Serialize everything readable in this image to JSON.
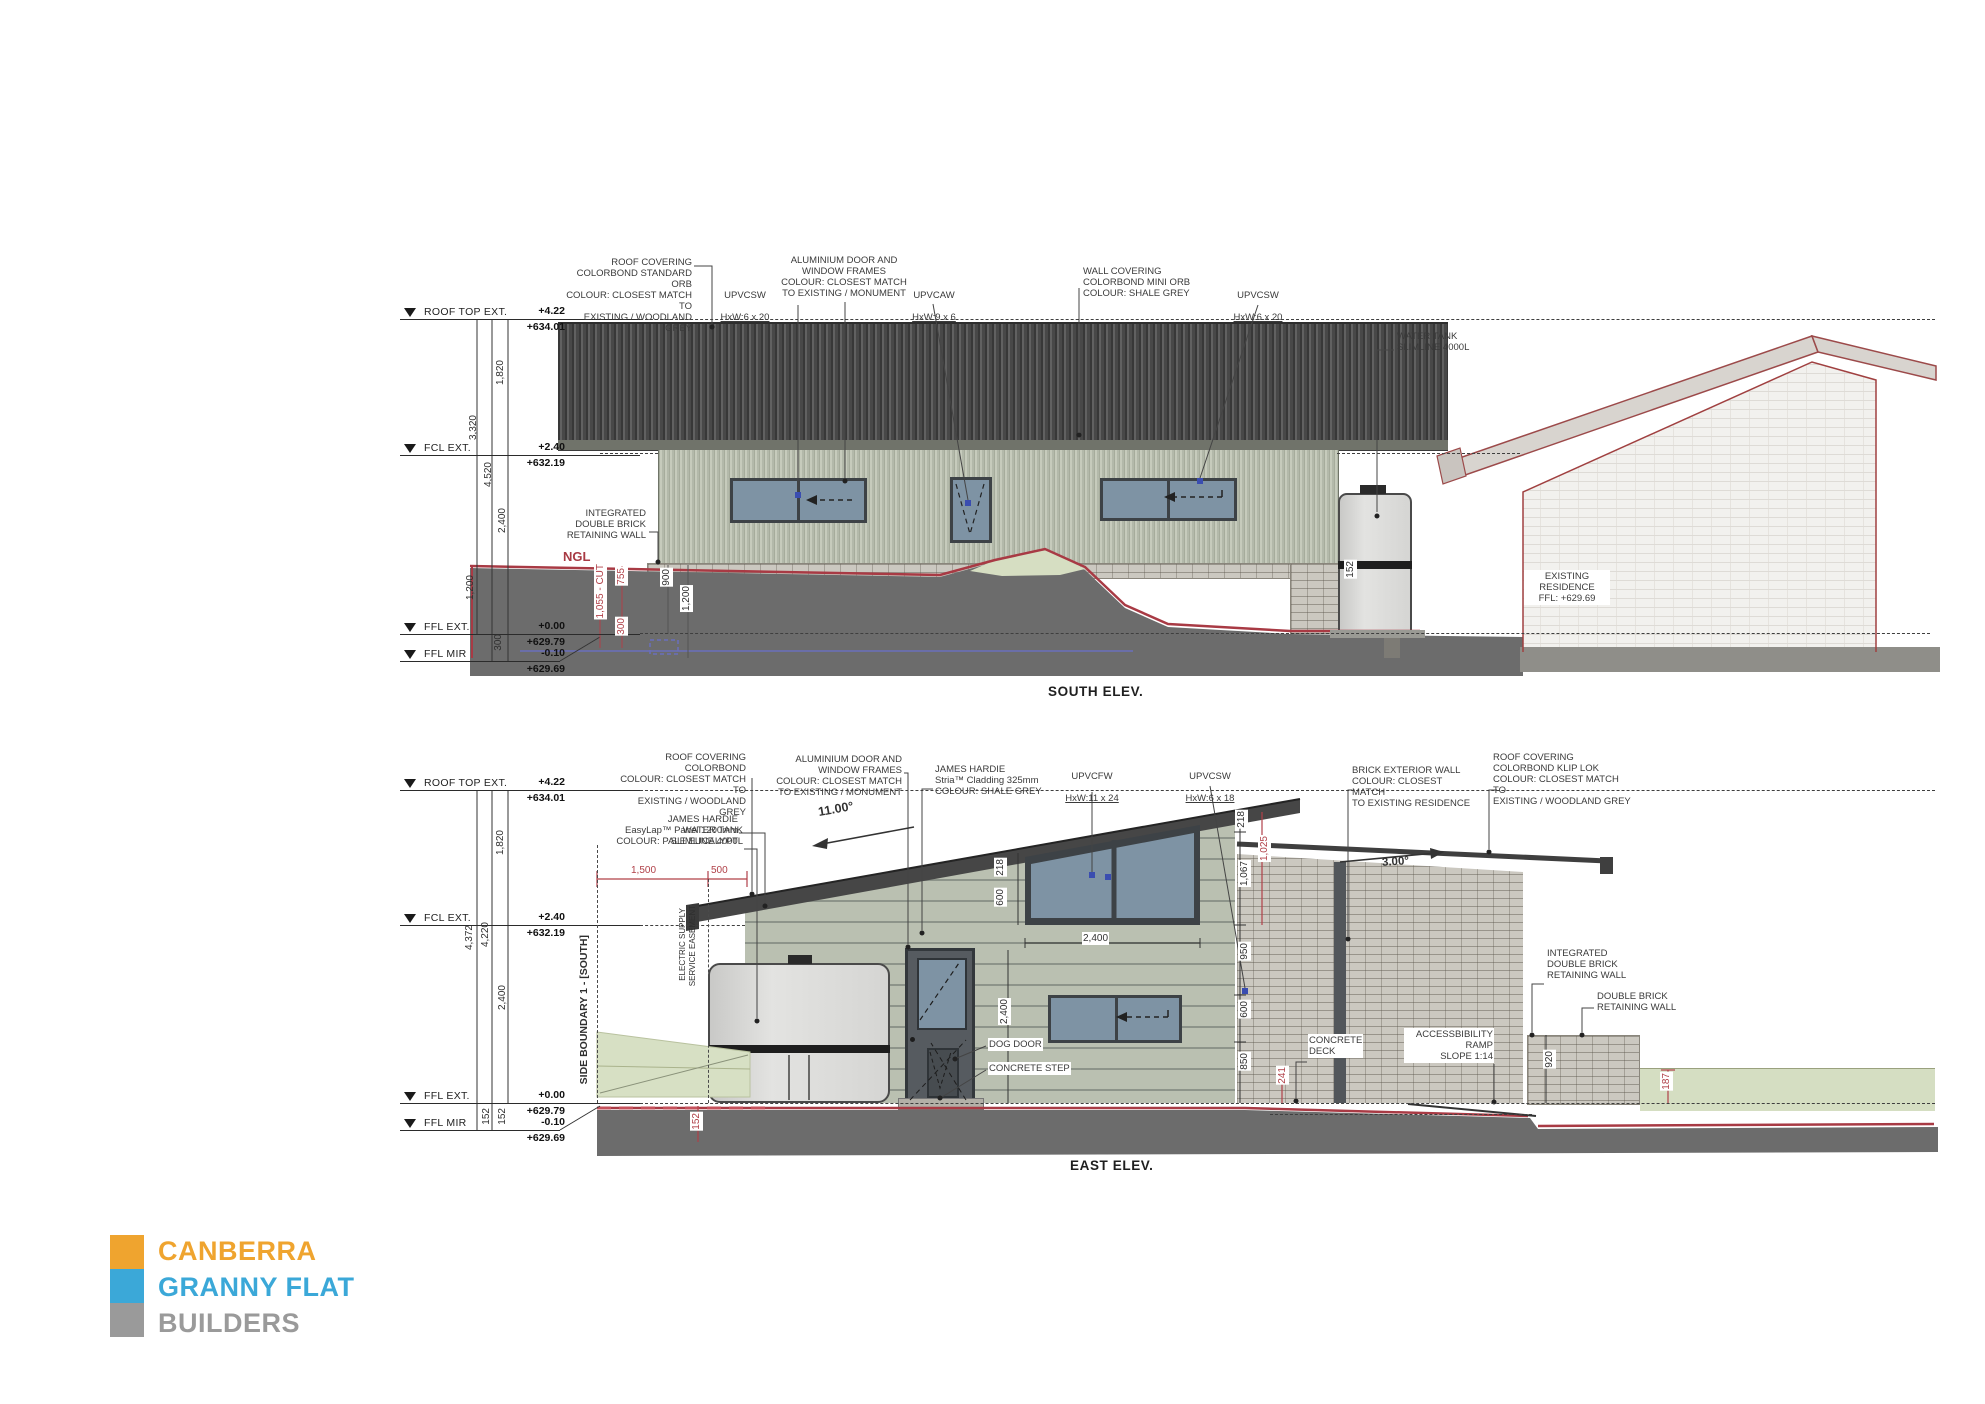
{
  "south": {
    "title": "SOUTH ELEV.",
    "datums": [
      {
        "label": "ROOF TOP EXT.",
        "rel": "+4.22",
        "abs": "+634.01"
      },
      {
        "label": "FCL EXT.",
        "rel": "+2.40",
        "abs": "+632.19"
      },
      {
        "label": "FFL EXT.",
        "rel": "+0.00",
        "abs": "+629.79"
      },
      {
        "label": "FFL MIR",
        "rel": "-0.10",
        "abs": "+629.69"
      }
    ],
    "ann": {
      "roof": "ROOF COVERING\nCOLORBOND STANDARD ORB\nCOLOUR: CLOSEST MATCH TO\nEXISTING / WOODLAND GREY",
      "upvc1_name": "UPVCSW",
      "upvc1_size": "HxW:6 x 20",
      "alu": "ALUMINIUM DOOR AND\nWINDOW FRAMES\nCOLOUR: CLOSEST MATCH\nTO EXISTING / MONUMENT",
      "upvc2_name": "UPVCAW",
      "upvc2_size": "HxW:9 x 6",
      "wall": "WALL COVERING\nCOLORBOND MINI ORB\nCOLOUR: SHALE GREY",
      "upvc3_name": "UPVCSW",
      "upvc3_size": "HxW:6 x 20",
      "retaining": "INTEGRATED\nDOUBLE BRICK\nRETAINING WALL",
      "ngl": "NGL",
      "tank": "WATER TANK\nSLIMLINE   4000L",
      "existing": "EXISTING\nRESIDENCE\nFFL: +629.69"
    },
    "dims": {
      "a": "1,820",
      "b": "3,320",
      "c": "4,520",
      "d": "2,400",
      "e": "1,200",
      "f": "300",
      "cut": "1,055 - CUT",
      "g": "755",
      "h": "300",
      "i": "900",
      "j": "1,200",
      "k": "152"
    }
  },
  "east": {
    "title": "EAST ELEV.",
    "datums": [
      {
        "label": "ROOF TOP EXT.",
        "rel": "+4.22",
        "abs": "+634.01"
      },
      {
        "label": "FCL EXT.",
        "rel": "+2.40",
        "abs": "+632.19"
      },
      {
        "label": "FFL EXT.",
        "rel": "+0.00",
        "abs": "+629.79"
      },
      {
        "label": "FFL MIR",
        "rel": "-0.10",
        "abs": "+629.69"
      }
    ],
    "ann": {
      "roof1": "ROOF COVERING\nCOLORBOND\nCOLOUR: CLOSEST MATCH TO\nEXISTING / WOODLAND GREY",
      "tank": "WATER TANK\nSLIMLINE   4000L",
      "alu": "ALUMINIUM DOOR AND\nWINDOW FRAMES\nCOLOUR: CLOSEST MATCH\nTO EXISTING / MONUMENT",
      "easylap": "JAMES HARDIE\nEasyLap™ Panel   1200mm\nCOLOUR: PALE EUCALYPT",
      "stria": "JAMES HARDIE\nStria™ Cladding   325mm\nCOLOUR: SHALE GREY",
      "upvcfw_name": "UPVCFW",
      "upvcfw_size": "HxW:11 x 24",
      "upvcsw_name": "UPVCSW",
      "upvcsw_size": "HxW:6 x 18",
      "brick": "BRICK EXTERIOR WALL\nCOLOUR: CLOSEST MATCH\nTO EXISTING RESIDENCE",
      "roof2": "ROOF COVERING\nCOLORBOND KLIP LOK\nCOLOUR: CLOSEST MATCH TO\nEXISTING / WOODLAND GREY",
      "slope_main": "11.00°",
      "slope_sec": "3.00°",
      "boundary": "SIDE BOUNDARY 1 - [SOUTH]",
      "easement1": "ELECTRIC SUPPLY",
      "easement2": "SERVICE EASEMENT",
      "dog": "DOG DOOR",
      "step": "CONCRETE STEP",
      "deck": "CONCRETE\nDECK",
      "ramp": "ACCESSBIBILITY\nRAMP\nSLOPE   1:14",
      "ret1": "INTEGRATED\nDOUBLE BRICK\nRETAINING WALL",
      "ret2": "DOUBLE BRICK\nRETAINING WALL"
    },
    "dims": {
      "a": "1,820",
      "b": "4,372",
      "c": "4,220",
      "d": "2,400",
      "e": "152",
      "f": "152",
      "r1500": "1,500",
      "r500": "500",
      "l218": "218",
      "l600": "600",
      "w2400": "2,400",
      "door2400": "2,400",
      "r218": "218",
      "r1067": "1,067",
      "r950": "950",
      "r600": "600",
      "r850": "850",
      "red1025": "1,025",
      "red241": "241",
      "d920": "920",
      "red187": "187",
      "red152": "152"
    }
  },
  "logo": {
    "l1": "CANBERRA",
    "l2": "GRANNY FLAT",
    "l3": "BUILDERS",
    "colors": {
      "orange": "#EFA42F",
      "blue": "#3BA8D8",
      "gray": "#9A9A9A"
    }
  }
}
